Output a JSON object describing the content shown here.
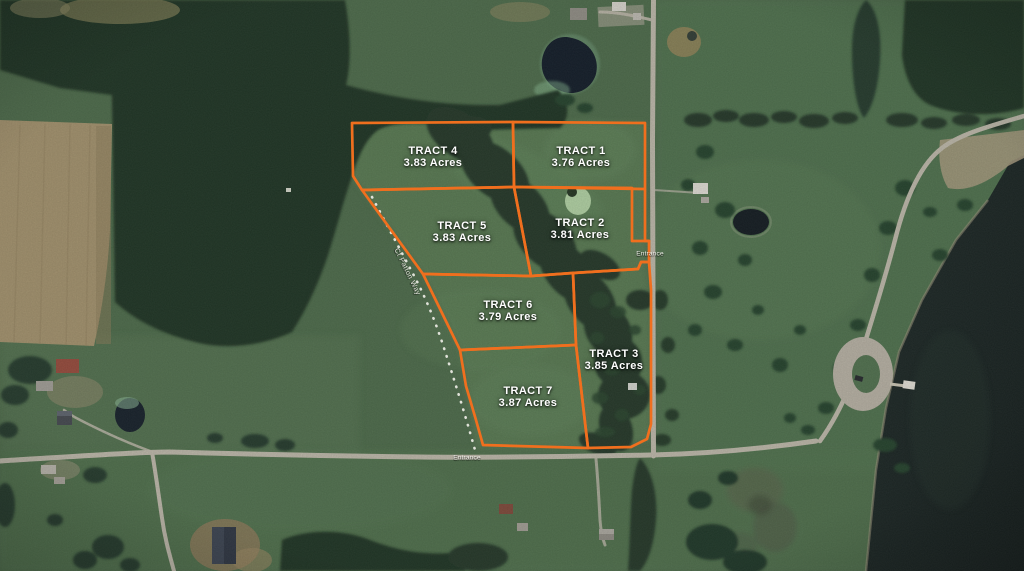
{
  "map": {
    "description": "Aerial parcel map with seven outlined land tracts",
    "tracts": [
      {
        "name": "TRACT 1",
        "acres": "3.76 Acres"
      },
      {
        "name": "TRACT 2",
        "acres": "3.81 Acres"
      },
      {
        "name": "TRACT 3",
        "acres": "3.85 Acres"
      },
      {
        "name": "TRACT 4",
        "acres": "3.83 Acres"
      },
      {
        "name": "TRACT 5",
        "acres": "3.83 Acres"
      },
      {
        "name": "TRACT 6",
        "acres": "3.79 Acres"
      },
      {
        "name": "TRACT 7",
        "acres": "3.87 Acres"
      }
    ],
    "labels": {
      "entrance_east": "Entrance",
      "entrance_south": "Entrance",
      "road_name": "Ct Patton Way"
    },
    "colors": {
      "boundary": "#F06F1E",
      "field": "#4A6848",
      "forest": "#1D3122",
      "water": "#18211F",
      "road": "#B9B4A6",
      "label_text": "#FFFFFF"
    }
  }
}
